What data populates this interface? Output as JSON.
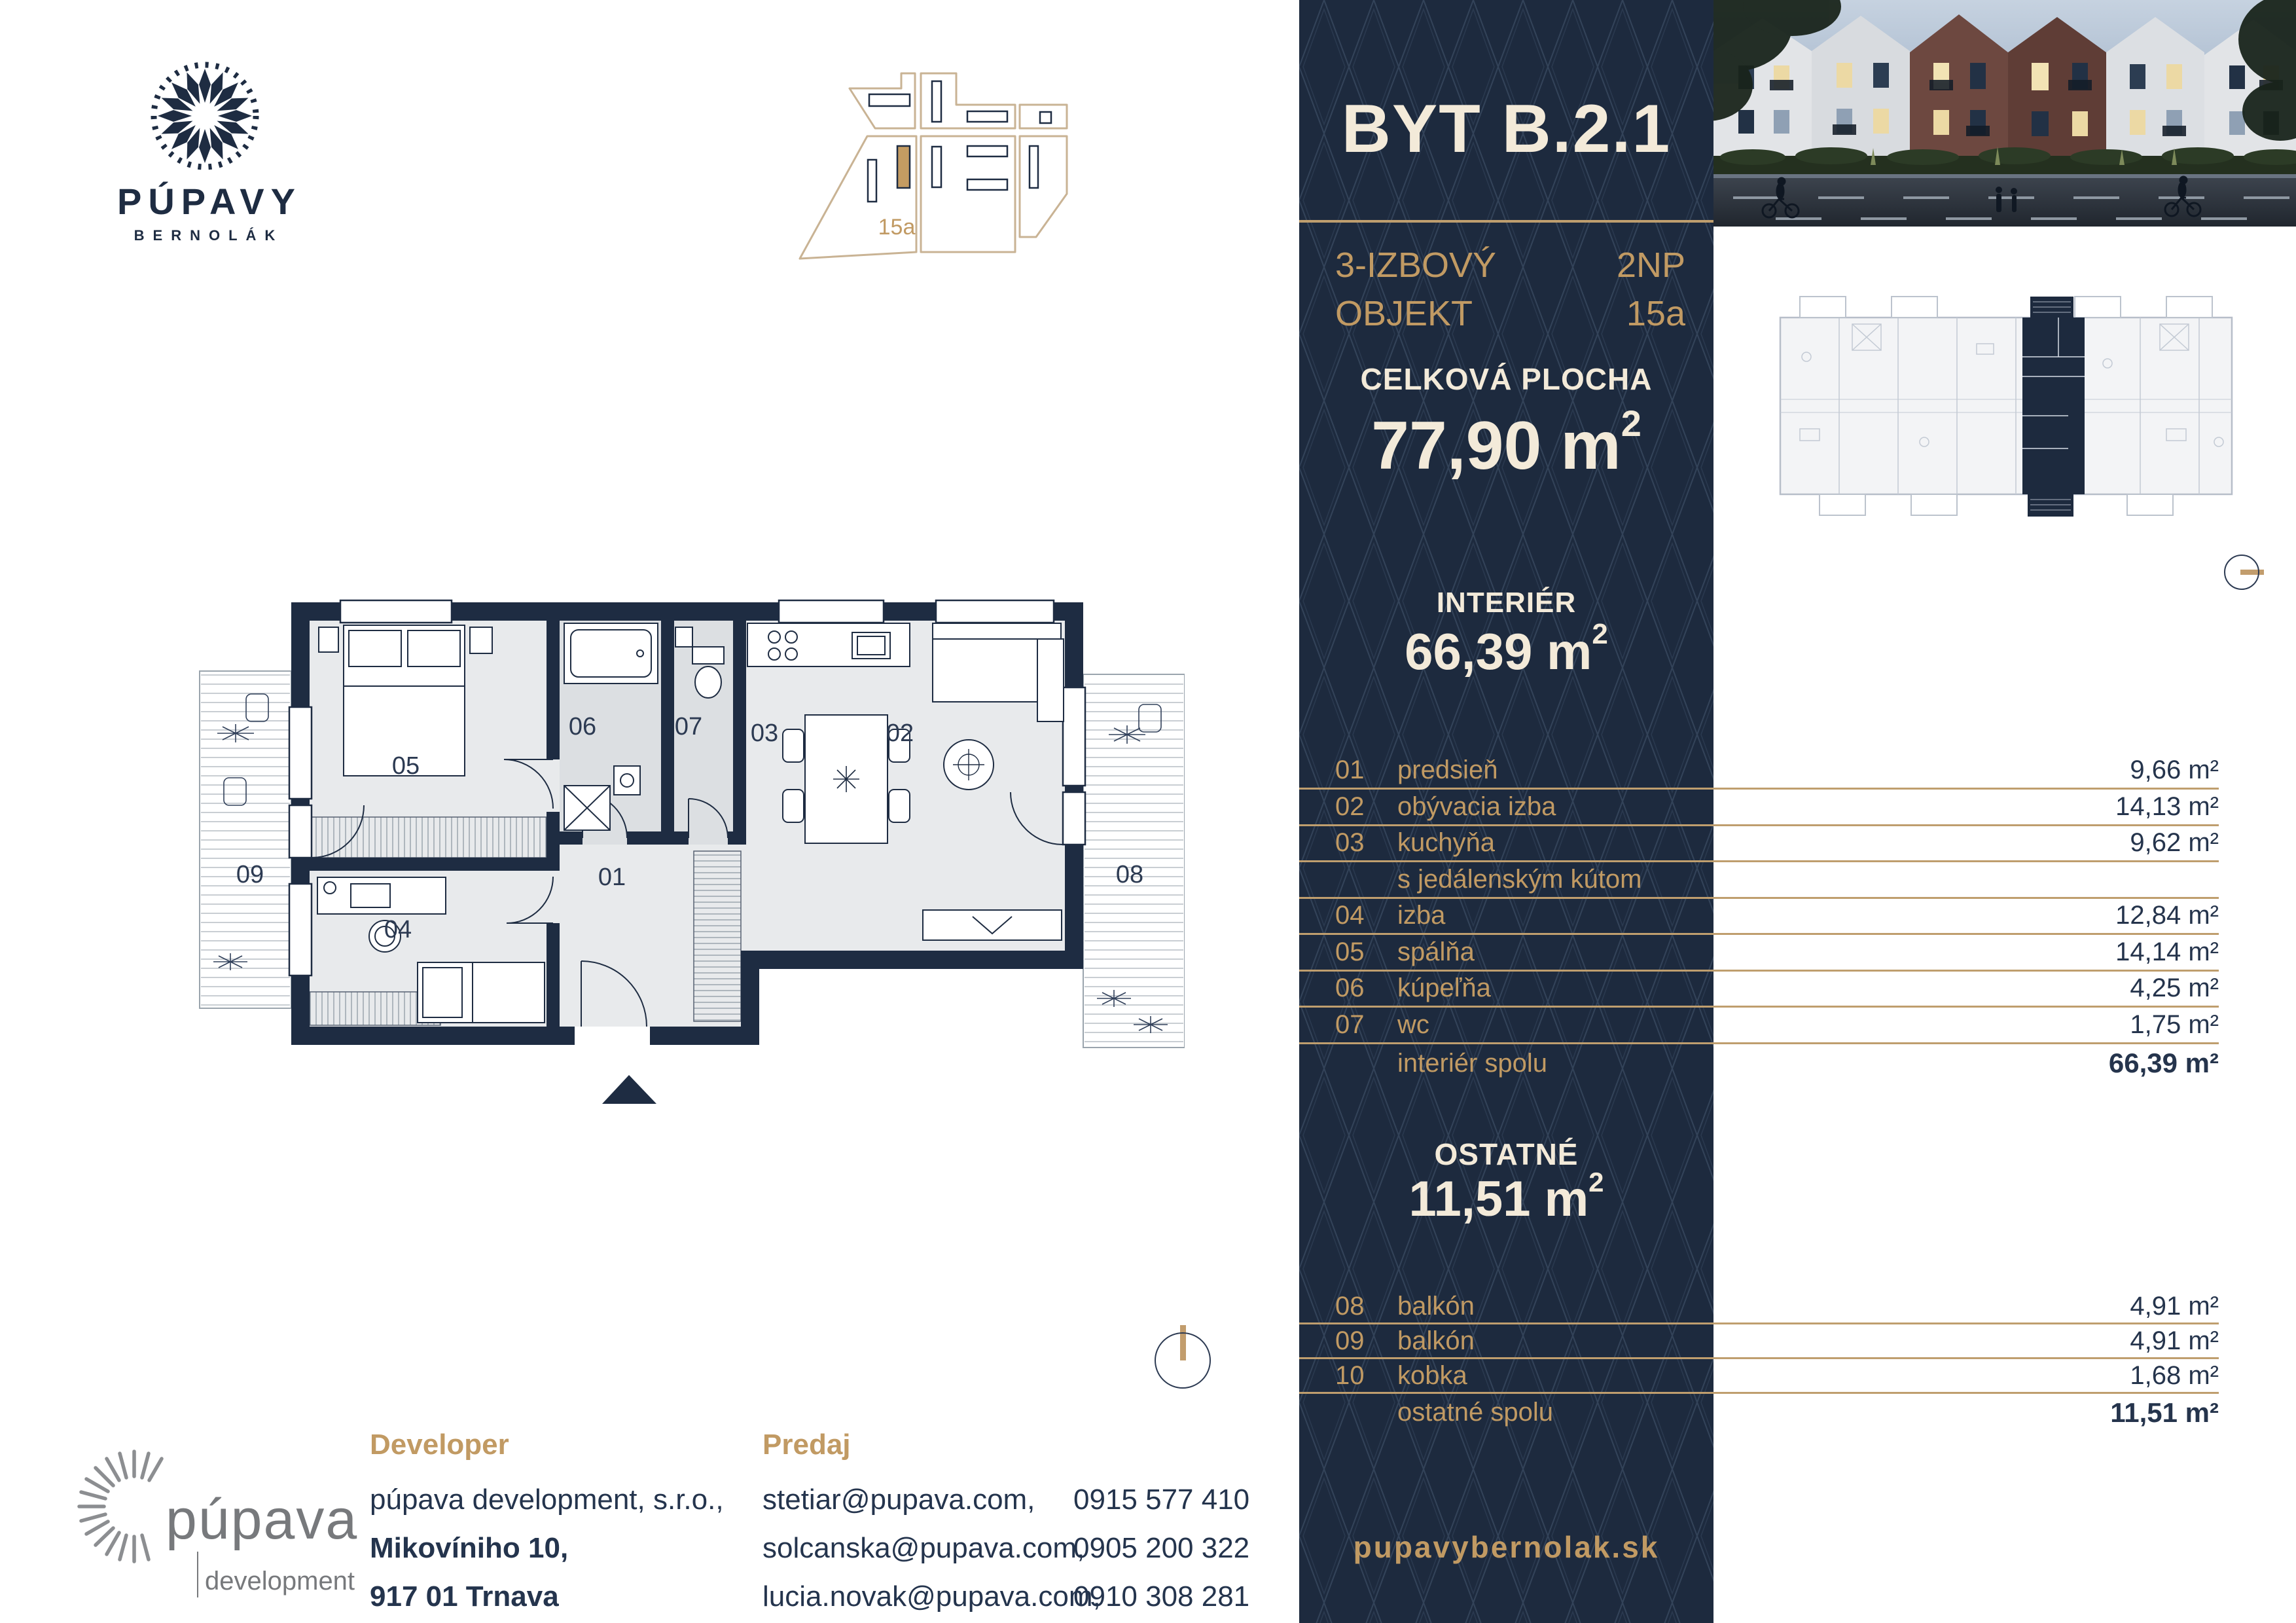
{
  "brand": {
    "name": "PÚPAVY",
    "subtitle": "BERNOLÁK"
  },
  "site_plan": {
    "building_label": "15a"
  },
  "panel": {
    "title": "BYT B.2.1",
    "type_line1": "3-IZBOVÝ",
    "type_line2": "OBJEKT",
    "floor": "2NP",
    "object": "15a",
    "total_label": "CELKOVÁ PLOCHA",
    "total_value": "77,90 m",
    "sup": "2",
    "interior_label": "INTERIÉR",
    "interior_value": "66,39 m",
    "other_label": "OSTATNÉ",
    "other_value": "11,51 m",
    "website": "pupavybernolak.sk"
  },
  "interior_rows": [
    {
      "no": "01",
      "name": "predsieň",
      "value": "9,66 m²"
    },
    {
      "no": "02",
      "name": "obývacia izba",
      "value": "14,13 m²"
    },
    {
      "no": "03",
      "name": "kuchyňa",
      "value": "9,62 m²"
    },
    {
      "no": "",
      "name": "s jedálenským kútom",
      "value": ""
    },
    {
      "no": "04",
      "name": "izba",
      "value": "12,84 m²"
    },
    {
      "no": "05",
      "name": "spálňa",
      "value": "14,14 m²"
    },
    {
      "no": "06",
      "name": "kúpeľňa",
      "value": "4,25 m²"
    },
    {
      "no": "07",
      "name": "wc",
      "value": "1,75 m²"
    },
    {
      "no": "",
      "name": "interiér spolu",
      "value": "66,39 m²"
    }
  ],
  "other_rows": [
    {
      "no": "08",
      "name": "balkón",
      "value": "4,91 m²"
    },
    {
      "no": "09",
      "name": "balkón",
      "value": "4,91 m²"
    },
    {
      "no": "10",
      "name": "kobka",
      "value": "1,68 m²"
    },
    {
      "no": "",
      "name": "ostatné spolu",
      "value": "11,51 m²"
    }
  ],
  "floor_plan": {
    "rooms": {
      "r01": "01",
      "r02": "02",
      "r03": "03",
      "r04": "04",
      "r05": "05",
      "r06": "06",
      "r07": "07",
      "r08": "08",
      "r09": "09"
    }
  },
  "developer": {
    "heading": "Developer",
    "line1": "púpava development, s.r.o.,",
    "line2": "Mikovíniho 10,",
    "line3": "917 01 Trnava"
  },
  "sales": {
    "heading": "Predaj",
    "contacts": [
      {
        "email": "stetiar@pupava.com,",
        "phone": "0915 577 410"
      },
      {
        "email": "solcanska@pupava.com,",
        "phone": "0905 200 322"
      },
      {
        "email": "lucia.novak@pupava.com,",
        "phone": "0910 308 281"
      }
    ]
  },
  "dev_logo": {
    "name": "púpava",
    "sub": "development"
  },
  "colors": {
    "navy": "#1d2a3e",
    "gold": "#c19a63",
    "cream": "#f3ead9"
  }
}
